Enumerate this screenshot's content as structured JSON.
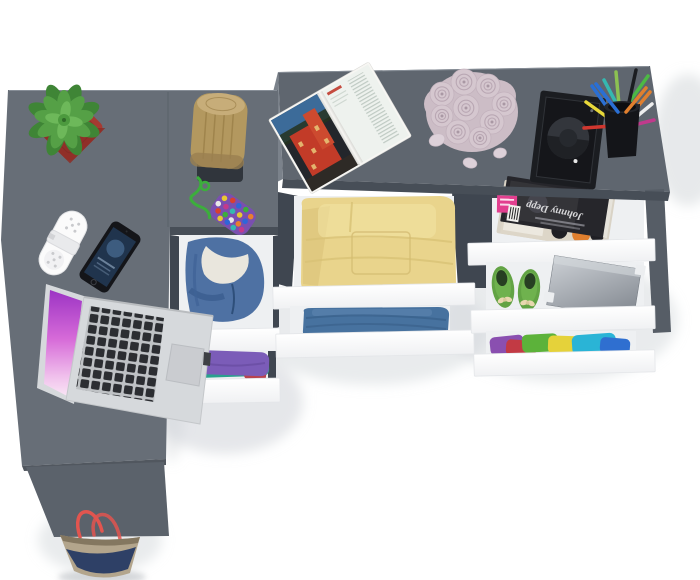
{
  "image": {
    "kind": "3D product render",
    "subject": "Graphite grey corner desk and chest, top view, with open white drawers holding clothes and accessories",
    "background": "#ffffff"
  },
  "furniture": {
    "desk_top_color": "#676e77",
    "dresser_top_color": "#5f666f",
    "side_highlight_color": "#7b828b",
    "edge_color": "#474e57",
    "rail_color": "#3f4650",
    "leg_color": "#565d66",
    "leg_panel_color": "#5b626b",
    "drawer_front_color": "#fdfdfe",
    "drawer_interior_color": "#eef0f2"
  },
  "desk_items": {
    "succulent": {
      "label": "potted succulent",
      "pot_color": "#a63a31",
      "plant_color": "#55a046",
      "plant_dark_color": "#3f8536"
    },
    "speaker": {
      "label": "white portable speaker",
      "color": "#fbfbfb"
    },
    "phone": {
      "label": "smartphone",
      "body_color": "#141519",
      "screen_color": "#20344d"
    },
    "laptop": {
      "label": "open laptop",
      "body_color": "#d6d9dc",
      "key_color": "#2c2e32",
      "screen_top_color": "#9c34c4",
      "screen_bottom_color": "#fae9f6"
    },
    "stump": {
      "label": "wooden stump decor",
      "wood_color": "#b3985f",
      "base_color": "#30353c"
    },
    "keychain": {
      "label": "beaded keychain",
      "cord_color": "#3cae3c"
    },
    "open_magazine": {
      "label": "open architecture magazine",
      "photo_red": "#c23b28",
      "photo_sky": "#3c6b99",
      "page_color": "#eef2ee"
    },
    "roses": {
      "label": "bouquet of pale roses",
      "color": "#d5c7cf"
    },
    "frame": {
      "label": "black photo frame",
      "color": "#1b1d21"
    },
    "pen_cup": {
      "label": "pen cup with pens",
      "cup_color": "#141519",
      "pen_colors": [
        "#4cb944",
        "#2a6fd4",
        "#d0372f",
        "#e07f2e",
        "#35b8b0",
        "#e8d83a",
        "#1b1d21",
        "#eeeeee",
        "#c03a8c",
        "#8cc152"
      ]
    }
  },
  "drawers": [
    {
      "position": "cabinet top",
      "contents": "blue hooded jacket",
      "content_color": "#4e71a3"
    },
    {
      "position": "cabinet bottom",
      "contents": "purple and teal folded clothes",
      "content_color": "#7b5cb8",
      "alt_color": "#2aa08e"
    },
    {
      "position": "chest centre top",
      "contents": "folded yellow clothes",
      "content_color": "#e9d48c"
    },
    {
      "position": "chest centre bottom",
      "contents": "blue jeans",
      "content_color": "#47729f"
    },
    {
      "position": "chest right top",
      "contents": "magazines",
      "magazine_title": "Johnny Depp",
      "sticker_color": "#e23f8f"
    },
    {
      "position": "chest right middle",
      "contents": "green ballet flats and metal box",
      "shoe_color": "#62a344",
      "box_color": "#9aa0a8"
    },
    {
      "position": "chest right bottom",
      "contents": "stack of colourful t-shirts",
      "content_colors": [
        "#8a4fb0",
        "#c23a44",
        "#5cb23a",
        "#e5d23a",
        "#2ab4d6",
        "#2f6fd0"
      ]
    }
  ],
  "floor_items": {
    "bag": {
      "label": "canvas tote bag",
      "body_color": "#b3a58c",
      "panel_color": "#2e4066",
      "handle_color": "#e2554f"
    }
  }
}
